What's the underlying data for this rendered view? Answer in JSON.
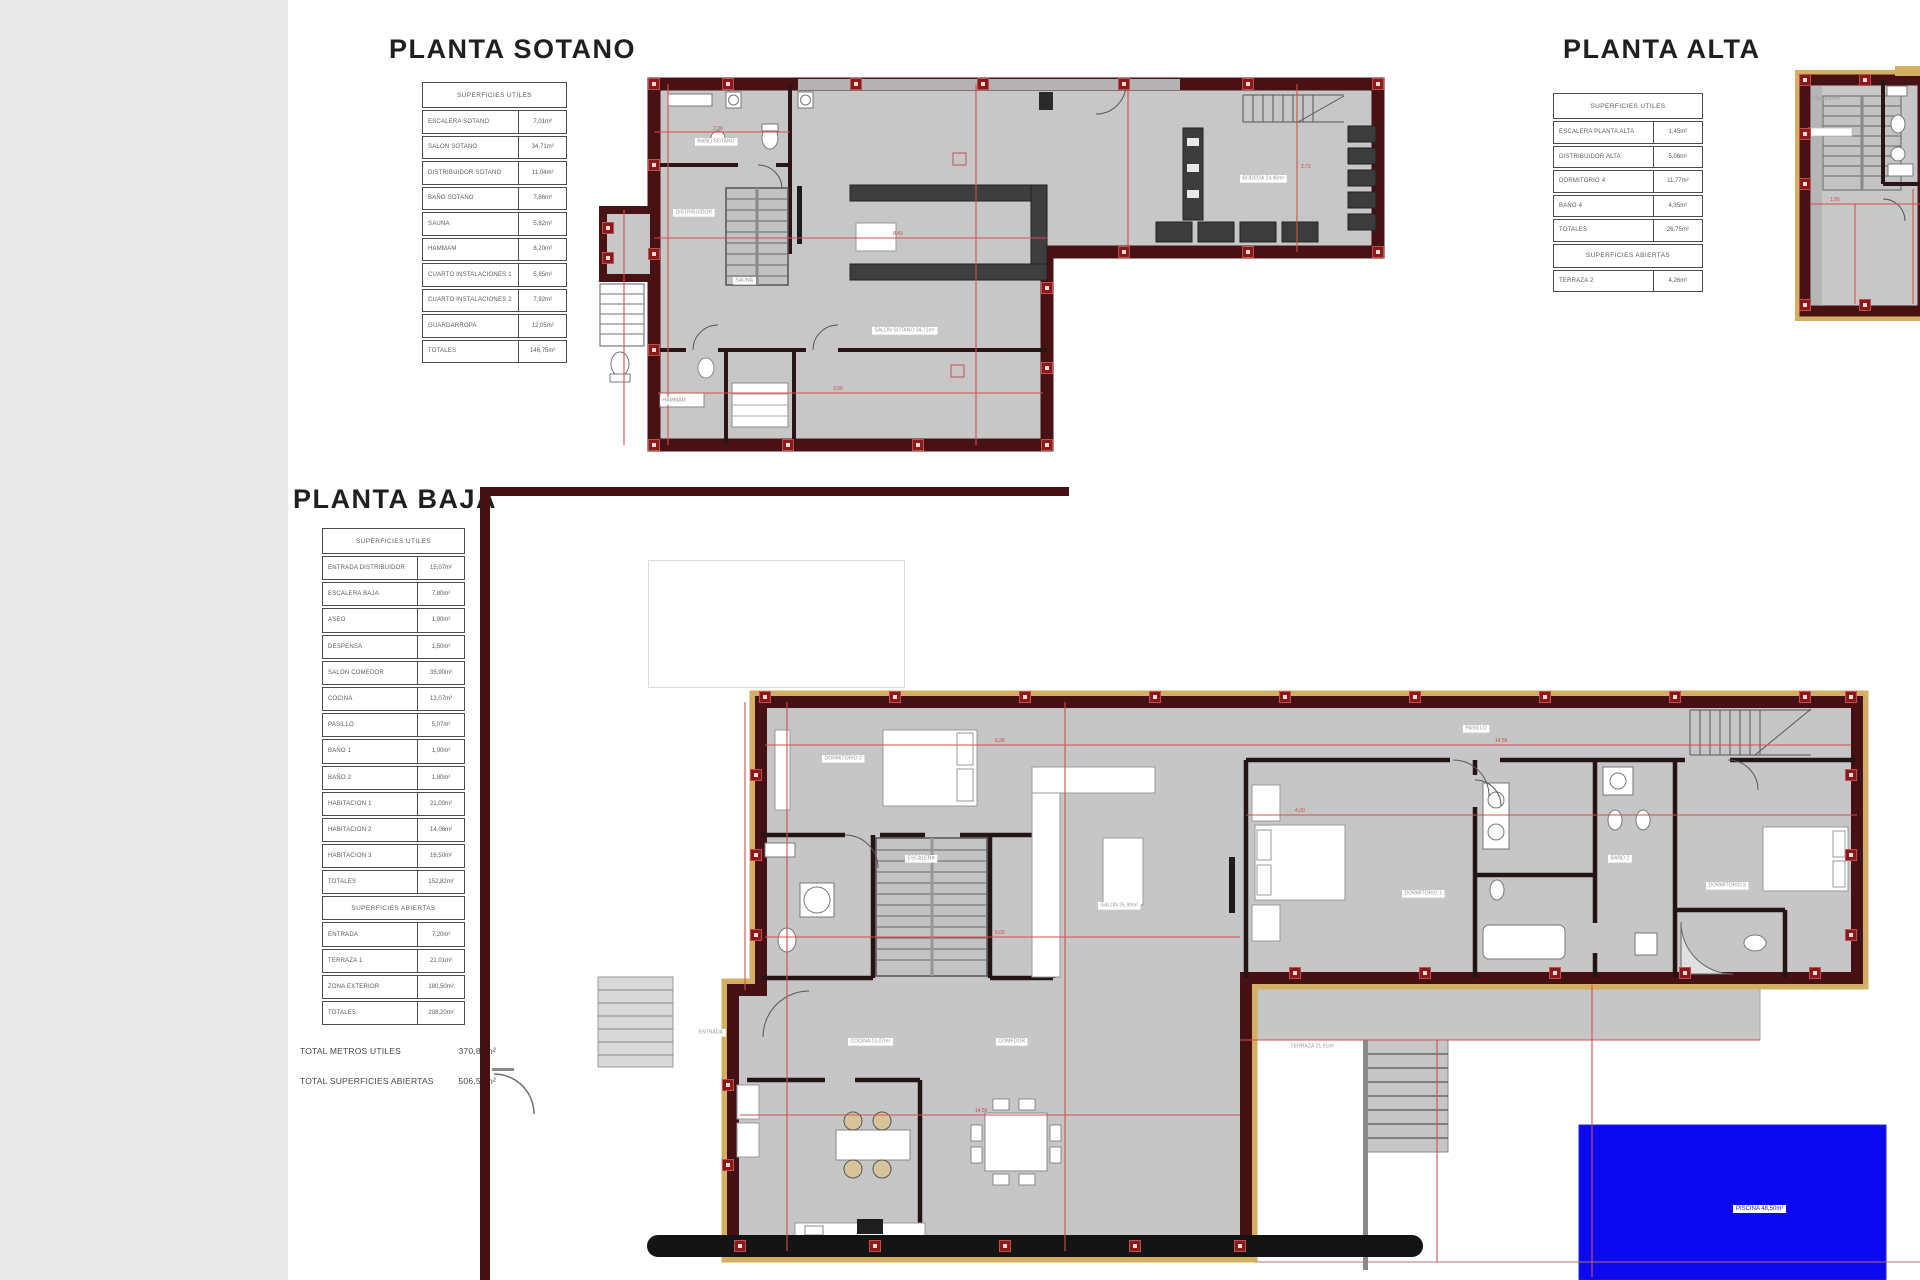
{
  "titles": {
    "sotano": "PLANTA SOTANO",
    "alta": "PLANTA ALTA",
    "baja": "PLANTA BAJA"
  },
  "tables": {
    "sotano": {
      "header": "SUPERFICIES UTILES",
      "rows": [
        {
          "label": "ESCALERA SOTANO",
          "value": "7,01m²"
        },
        {
          "label": "SALON SOTANO",
          "value": "34,71m²"
        },
        {
          "label": "DISTRIBUIDOR SOTANO",
          "value": "11,04m²"
        },
        {
          "label": "BAÑO SOTANO",
          "value": "7,86m²"
        },
        {
          "label": "SAUNA",
          "value": "5,82m²"
        },
        {
          "label": "HAMMAM",
          "value": "8,20m²"
        },
        {
          "label": "CUARTO INSTALACIONES 1",
          "value": "5,85m²"
        },
        {
          "label": "CUARTO INSTALACIONES 2",
          "value": "7,92m²"
        },
        {
          "label": "GUARDARROPA",
          "value": "12,05m²"
        },
        {
          "label": "TOTALES",
          "value": "146,75m²"
        }
      ]
    },
    "alta": {
      "header": "SUPERFICIES UTILES",
      "rows": [
        {
          "label": "ESCALERA PLANTA ALTA",
          "value": "1,45m²"
        },
        {
          "label": "DISTRIBUIDOR ALTA",
          "value": "5,06m²"
        },
        {
          "label": "DORMITORIO 4",
          "value": "11,77m²"
        },
        {
          "label": "BAÑO 4",
          "value": "4,35m²"
        },
        {
          "label": "TOTALES",
          "value": "26,75m²"
        }
      ],
      "section2": "SUPERFICIES ABIERTAS",
      "rows2": [
        {
          "label": "TERRAZA 2",
          "value": "4,26m²"
        }
      ]
    },
    "baja": {
      "header": "SUPERFICIES UTILES",
      "rows": [
        {
          "label": "ENTRADA DISTRIBUIDOR",
          "value": "15,07m²"
        },
        {
          "label": "ESCALERA BAJA",
          "value": "7,80m²"
        },
        {
          "label": "ASEO",
          "value": "1,90m²"
        },
        {
          "label": "DESPENSA",
          "value": "1,50m²"
        },
        {
          "label": "SALON COMEDOR",
          "value": "35,90m²"
        },
        {
          "label": "COCINA",
          "value": "13,07m²"
        },
        {
          "label": "PASILLO",
          "value": "5,07m²"
        },
        {
          "label": "BAÑO 1",
          "value": "1,90m²"
        },
        {
          "label": "BAÑO 2",
          "value": "1,80m²"
        },
        {
          "label": "HABITACION 1",
          "value": "21,00m²"
        },
        {
          "label": "HABITACION 2",
          "value": "14,06m²"
        },
        {
          "label": "HABITACION 3",
          "value": "16,50m²"
        },
        {
          "label": "TOTALES",
          "value": "152,82m²"
        }
      ],
      "section2": "SUPERFICIES ABIERTAS",
      "rows2": [
        {
          "label": "ENTRADA",
          "value": "7,20m²"
        },
        {
          "label": "TERRAZA 1",
          "value": "21,01m²"
        },
        {
          "label": "ZONA EXTERIOR",
          "value": "180,50m²"
        },
        {
          "label": "TOTALES",
          "value": "208,20m²"
        }
      ]
    }
  },
  "footer": {
    "line1_label": "TOTAL METROS UTILES",
    "line1_value": "370,87m²",
    "line2_label": "TOTAL SUPERFICIES ABIERTAS",
    "line2_value": "506,56m²"
  },
  "labels": {
    "sotano": [
      {
        "text": "DISTRIBUIDOR"
      },
      {
        "text": "SALON SOTANO 34,71m²"
      },
      {
        "text": "BODEGA 24,90m²"
      },
      {
        "text": "BAÑO SOTANO"
      },
      {
        "text": "SAUNA"
      },
      {
        "text": "HAMMAM"
      }
    ],
    "baja": [
      {
        "text": "DORMITORIO 2"
      },
      {
        "text": "ESCALERA"
      },
      {
        "text": "COCINA 13,07m²"
      },
      {
        "text": "COMEDOR"
      },
      {
        "text": "SALON 35,90m²"
      },
      {
        "text": "DORMITORIO 1"
      },
      {
        "text": "PASILLO"
      },
      {
        "text": "BAÑO 2"
      },
      {
        "text": "DORMITORIO 3"
      },
      {
        "text": "TERRAZA 21,01m²"
      },
      {
        "text": "ENTRADA"
      }
    ],
    "alta": [
      {
        "text": "ESCALERA"
      }
    ],
    "pool": "PISCINA 48,50m²"
  },
  "dims": {
    "sotano": [
      "2,30",
      "8,43",
      "3,95",
      "2,72"
    ],
    "baja": [
      "6,26",
      "14,56",
      "5,00",
      "4,00",
      "14,56"
    ],
    "alta": [
      "1,95"
    ]
  },
  "colors": {
    "wall": "#451114",
    "floor": "#c7c7c7",
    "new_wall_tan": "#d2af62",
    "dimension_red": "#d0504e",
    "pool_blue": "#0c08ef"
  }
}
